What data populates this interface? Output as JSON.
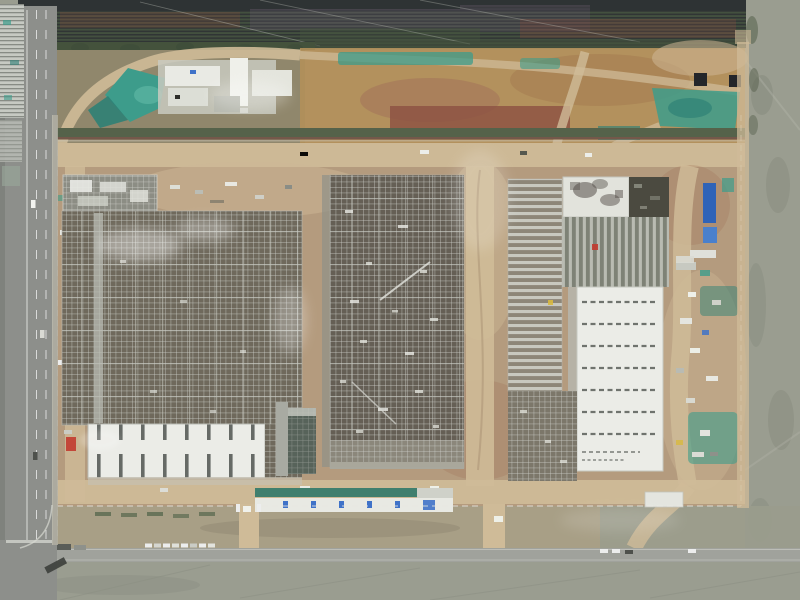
{
  "meta": {
    "description": "Aerial drone photograph, top-down view of a large industrial construction site: three steel-frame factory halls under construction surrounded by dirt roads, teal dust tarps, temporary site offices, a multi-lane road on the west edge, tilled farmland band on the north, and grey fields to the east and south"
  },
  "colors": {
    "field": "#9a9d90",
    "field_dark": "#878b7e",
    "farm_dark": "#2e3334",
    "farm_green": "#43503f",
    "farm_purple": "#5d5361",
    "farm_maroon": "#74493f",
    "hedge": "#44523c",
    "olive": "#8a8468",
    "sand": "#b2905a",
    "dirt": "#b49b7e",
    "dirt_light": "#cdb795",
    "dirt_red": "#a2735a",
    "dirt_red2": "#8c5042",
    "road_dirt": "#cfbb98",
    "asphalt": "#8d8f8b",
    "concrete": "#b2afa2",
    "teal": "#3d9c8b",
    "teal_dark": "#2f8176",
    "frame_line": "#c9ccc5",
    "frame_bar": "#d2d4cc",
    "frame_mid": "#8c8d84",
    "frame_dark_l": "#6f695c",
    "frame_dark_m": "#655f55",
    "roof_white": "#ebece7",
    "roof_dash": "#4f5450",
    "white": "#f1f2ee",
    "blue": "#3f72c8",
    "blue_roof": "#2f63b8",
    "green_roof": "#3f7f6e",
    "red": "#c23b30",
    "yellow": "#d8b93f",
    "dark": "#24262a"
  },
  "scene": {
    "regions": [
      {
        "id": "farmland-band",
        "label": "tilled farmland rows, north edge"
      },
      {
        "id": "west-greenhouses",
        "label": "greenhouse / panel strip, top-left"
      },
      {
        "id": "west-road",
        "label": "multi-lane asphalt road, west edge"
      },
      {
        "id": "upper-staging-area",
        "label": "excavated staging ground with batching plant and teal tarps"
      },
      {
        "id": "building-left-complex",
        "label": "west factory hall, steel frame with white roof section"
      },
      {
        "id": "building-middle",
        "label": "central factory hall, steel frame"
      },
      {
        "id": "building-right-complex",
        "label": "east factory hall, partially roofed white"
      },
      {
        "id": "right-margin-laydown",
        "label": "material laydown yard with blue temporary buildings"
      },
      {
        "id": "south-strip",
        "label": "site offices, gates and south verge"
      },
      {
        "id": "south-road",
        "label": "south asphalt road with parked cars"
      },
      {
        "id": "east-field",
        "label": "grey-green field, east edge"
      },
      {
        "id": "south-field",
        "label": "grey field, south edge"
      }
    ]
  }
}
